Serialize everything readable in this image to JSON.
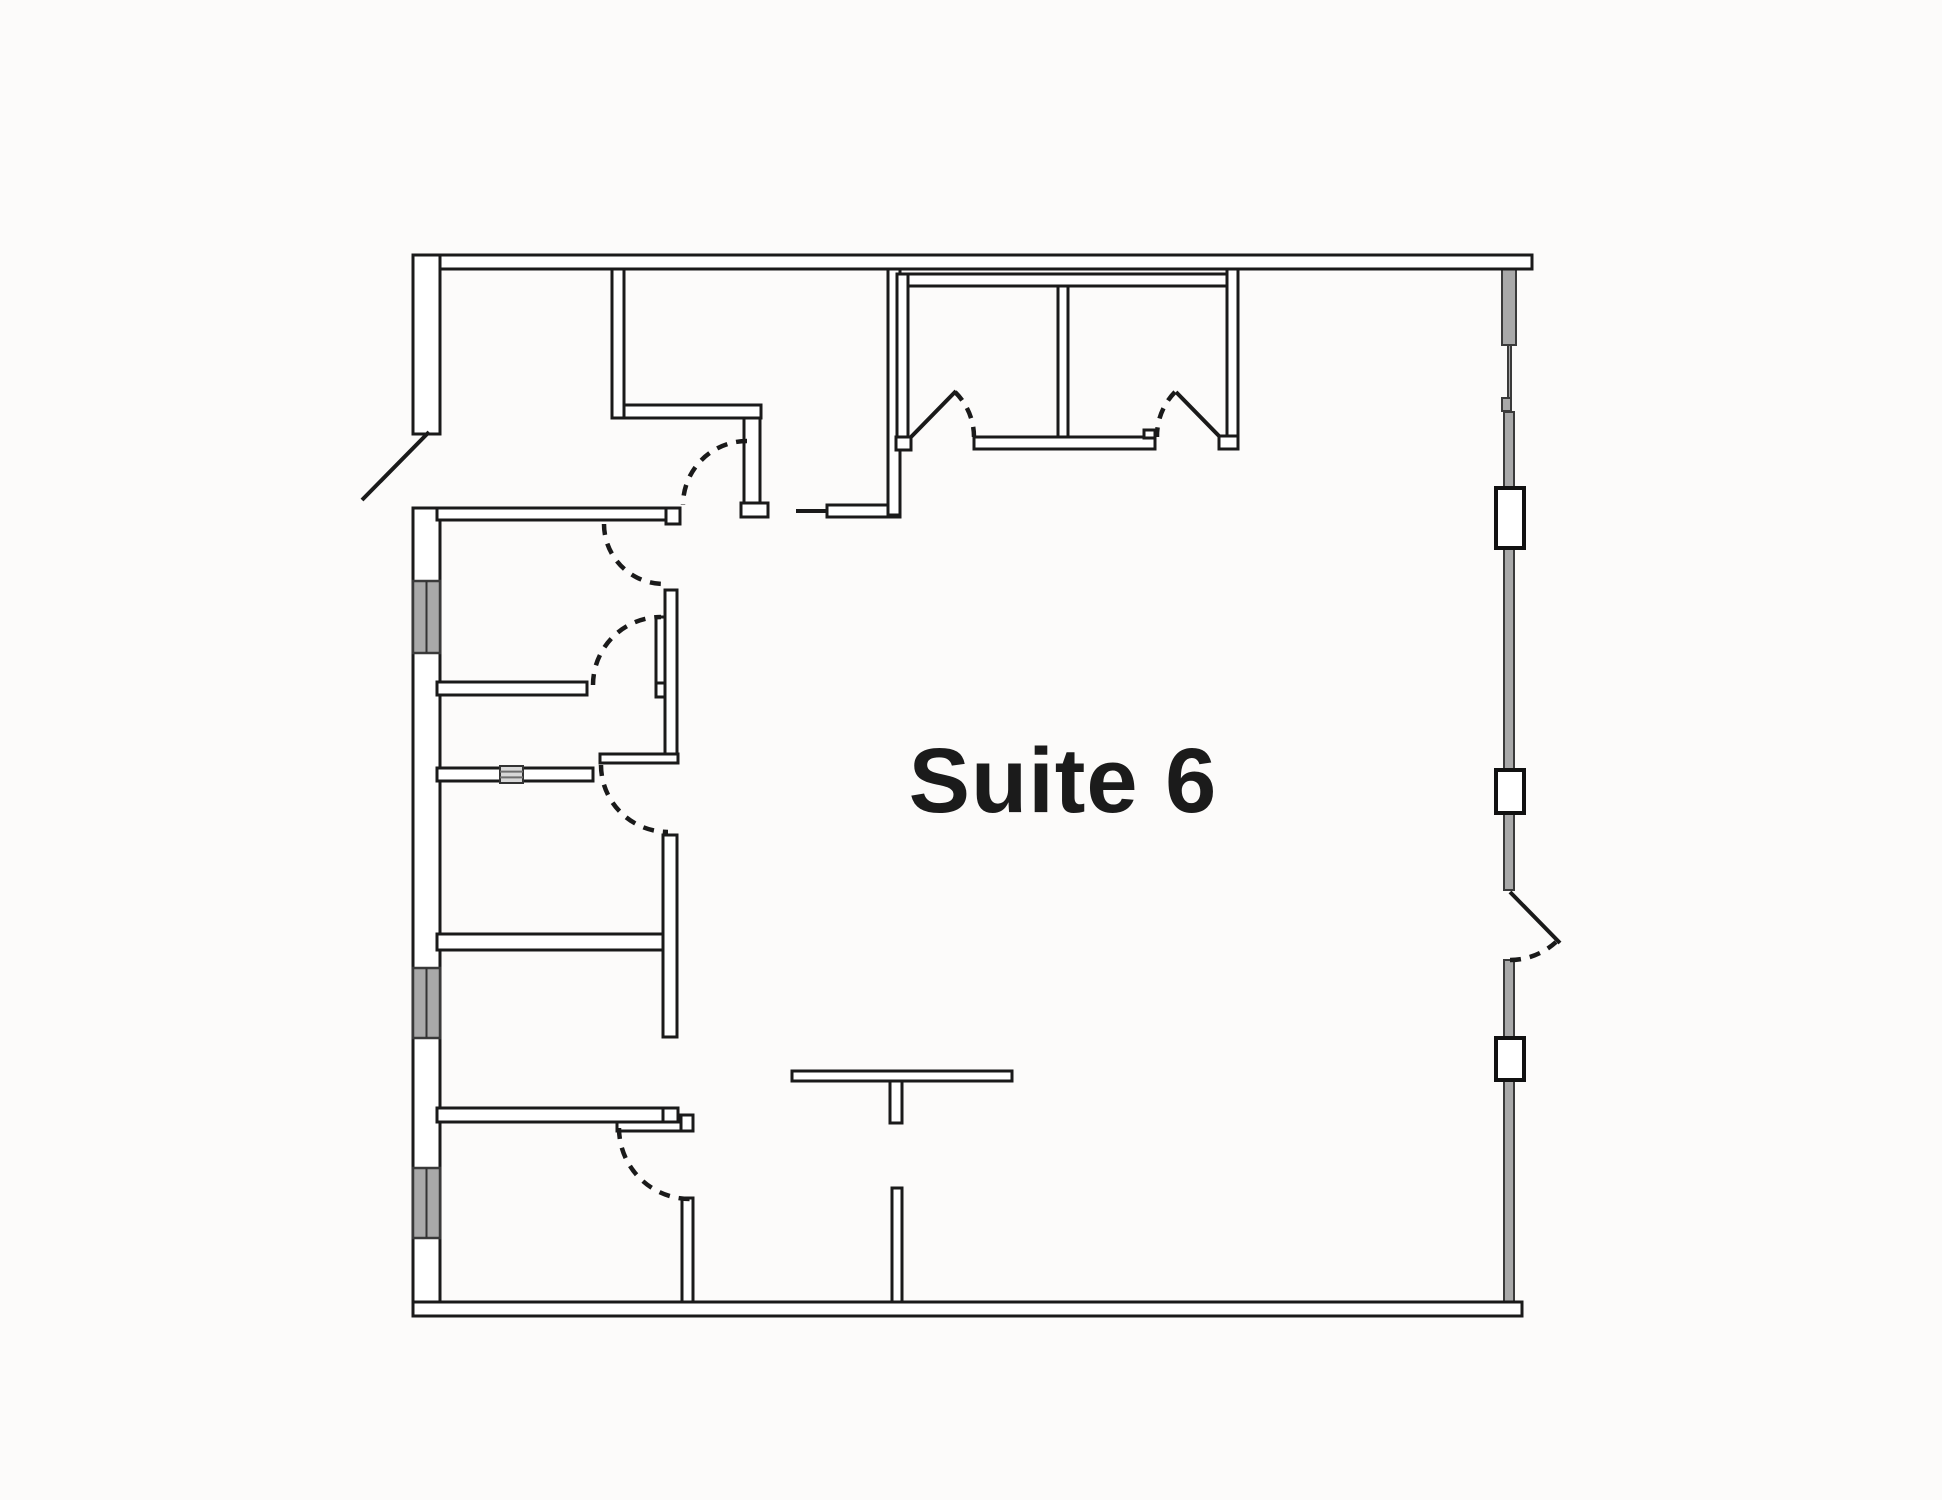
{
  "plan": {
    "label": {
      "text": "Suite 6"
    },
    "colors": {
      "background": "#fcfbfa",
      "wall_stroke": "#1a1a1a",
      "wall_fill": "#ffffff",
      "window_fill": "#a9a9a9",
      "window_stroke": "#3a3a3a",
      "block_stroke": "#111111",
      "label": "#1b1b1b"
    },
    "walls": [
      {
        "name": "top-wall",
        "x": 413,
        "y": 255,
        "w": 1119,
        "h": 14
      },
      {
        "name": "left-wall-upper",
        "x": 413,
        "y": 255,
        "w": 27,
        "h": 179
      },
      {
        "name": "left-wall-lower",
        "x": 413,
        "y": 508,
        "w": 27,
        "h": 794
      },
      {
        "name": "bottom-wall",
        "x": 413,
        "y": 1302,
        "w": 1109,
        "h": 14
      },
      {
        "name": "corridor-top-wall",
        "x": 437,
        "y": 508,
        "w": 243,
        "h": 12
      },
      {
        "name": "corridor-top-wall-jamb",
        "x": 666,
        "y": 508,
        "w": 14,
        "h": 16
      },
      {
        "name": "room-a-right-wall",
        "x": 612,
        "y": 269,
        "w": 12,
        "h": 149
      },
      {
        "name": "vestibule-wall-horizontal",
        "x": 624,
        "y": 405,
        "w": 137,
        "h": 13
      },
      {
        "name": "vestibule-wall-vertical",
        "x": 744,
        "y": 418,
        "w": 16,
        "h": 86
      },
      {
        "name": "vestibule-wall-foot",
        "x": 741,
        "y": 503,
        "w": 27,
        "h": 14
      },
      {
        "name": "corridor-south-wall",
        "x": 827,
        "y": 505,
        "w": 73,
        "h": 12
      },
      {
        "name": "room-b-right-wall",
        "x": 888,
        "y": 269,
        "w": 12,
        "h": 246
      },
      {
        "name": "room-bc-door-jamb",
        "x": 896,
        "y": 437,
        "w": 15,
        "h": 13
      },
      {
        "name": "rooms-cd-top-wall",
        "x": 897,
        "y": 274,
        "w": 340,
        "h": 12
      },
      {
        "name": "room-c-left-wall",
        "x": 897,
        "y": 274,
        "w": 11,
        "h": 163
      },
      {
        "name": "rooms-cd-divider-wall",
        "x": 1058,
        "y": 286,
        "w": 10,
        "h": 151
      },
      {
        "name": "rooms-cd-bottom-wall",
        "x": 974,
        "y": 437,
        "w": 181,
        "h": 12
      },
      {
        "name": "rooms-cd-bottom-notch",
        "x": 1144,
        "y": 430,
        "w": 11,
        "h": 8
      },
      {
        "name": "room-d-right-wall",
        "x": 1227,
        "y": 269,
        "w": 11,
        "h": 168
      },
      {
        "name": "room-d-right-wall-foot",
        "x": 1219,
        "y": 436,
        "w": 19,
        "h": 13
      },
      {
        "name": "left-room1-bottom-wall",
        "x": 437,
        "y": 682,
        "w": 150,
        "h": 13
      },
      {
        "name": "left-door1-leaf",
        "x": 656,
        "y": 617,
        "w": 10,
        "h": 67
      },
      {
        "name": "left-door1-jamb",
        "x": 656,
        "y": 683,
        "w": 18,
        "h": 14
      },
      {
        "name": "left-cluster-east-wall-upper",
        "x": 665,
        "y": 590,
        "w": 12,
        "h": 170
      },
      {
        "name": "left-door2-leaf",
        "x": 600,
        "y": 754,
        "w": 78,
        "h": 9
      },
      {
        "name": "left-room2-bottom-wall",
        "x": 437,
        "y": 768,
        "w": 156,
        "h": 13
      },
      {
        "name": "left-cluster-east-wall-mid",
        "x": 663,
        "y": 835,
        "w": 14,
        "h": 202
      },
      {
        "name": "left-room3-bottom-wall",
        "x": 437,
        "y": 934,
        "w": 226,
        "h": 16
      },
      {
        "name": "left-room4-bottom-wall",
        "x": 437,
        "y": 1108,
        "w": 226,
        "h": 14
      },
      {
        "name": "left-room4-bottom-jamb",
        "x": 663,
        "y": 1108,
        "w": 15,
        "h": 14
      },
      {
        "name": "left-door3-leaf",
        "x": 617,
        "y": 1122,
        "w": 76,
        "h": 9
      },
      {
        "name": "left-door3-leaf-cap",
        "x": 681,
        "y": 1115,
        "w": 12,
        "h": 16
      },
      {
        "name": "left-cluster-east-wall-lower",
        "x": 682,
        "y": 1198,
        "w": 11,
        "h": 104
      },
      {
        "name": "t-wall-bar",
        "x": 792,
        "y": 1071,
        "w": 220,
        "h": 10
      },
      {
        "name": "t-wall-stem",
        "x": 890,
        "y": 1081,
        "w": 12,
        "h": 42
      },
      {
        "name": "bottom-stub-wall",
        "x": 892,
        "y": 1188,
        "w": 10,
        "h": 114
      }
    ],
    "door_leaves": [
      {
        "name": "entry-door-leaf",
        "x1": 429,
        "y1": 432,
        "x2": 362,
        "y2": 500
      },
      {
        "name": "corridor-door-closed-leaf",
        "x1": 796,
        "y1": 511,
        "x2": 827,
        "y2": 511
      },
      {
        "name": "room-c-door-leaf",
        "x1": 911,
        "y1": 437,
        "x2": 956,
        "y2": 391
      },
      {
        "name": "room-d-door-leaf",
        "x1": 1220,
        "y1": 437,
        "x2": 1176,
        "y2": 392
      },
      {
        "name": "right-exit-door-leaf",
        "x1": 1510,
        "y1": 892,
        "x2": 1560,
        "y2": 943
      }
    ],
    "door_swings": [
      {
        "name": "vestibule-door-swing",
        "d": "M747,441 A64,64 0 0 0 683,505"
      },
      {
        "name": "left-room1-entry-swing",
        "d": "M604,524 A60,60 0 0 0 664,584"
      },
      {
        "name": "room-c-door-swing",
        "d": "M955,392 A63,63 0 0 1 974,437"
      },
      {
        "name": "room-d-door-swing",
        "d": "M1175,392 A63,63 0 0 0 1157,437"
      },
      {
        "name": "left-door1-swing",
        "d": "M593,685 A68,68 0 0 1 661,617"
      },
      {
        "name": "left-door2-swing",
        "d": "M601,765 A67,67 0 0 0 668,832"
      },
      {
        "name": "left-door3-swing",
        "d": "M619,1128 A71,71 0 0 0 690,1199"
      },
      {
        "name": "right-exit-door-swing",
        "d": "M1510,960 A68,68 0 0 0 1556,942"
      }
    ],
    "windows": [
      {
        "name": "window-left-1",
        "x": 413,
        "y": 581,
        "w": 27,
        "h": 72
      },
      {
        "name": "window-left-2",
        "x": 413,
        "y": 968,
        "w": 27,
        "h": 70
      },
      {
        "name": "window-left-3",
        "x": 413,
        "y": 1168,
        "w": 27,
        "h": 70
      }
    ],
    "glazing": [
      {
        "name": "right-glazing-1",
        "x": 1502,
        "y": 269,
        "w": 14,
        "h": 76
      },
      {
        "name": "right-glazing-thin",
        "x": 1508,
        "y": 345,
        "w": 3,
        "h": 67
      },
      {
        "name": "right-glazing-tick",
        "x": 1502,
        "y": 398,
        "w": 9,
        "h": 13
      },
      {
        "name": "right-glazing-2",
        "x": 1504,
        "y": 412,
        "w": 10,
        "h": 76
      },
      {
        "name": "right-glazing-3",
        "x": 1504,
        "y": 548,
        "w": 10,
        "h": 222
      },
      {
        "name": "right-glazing-4",
        "x": 1504,
        "y": 813,
        "w": 10,
        "h": 77
      },
      {
        "name": "right-glazing-5",
        "x": 1504,
        "y": 960,
        "w": 10,
        "h": 78
      },
      {
        "name": "right-glazing-6",
        "x": 1504,
        "y": 1080,
        "w": 10,
        "h": 222
      }
    ],
    "mullion_blocks": [
      {
        "name": "right-mullion-1",
        "x": 1496,
        "y": 488,
        "w": 28,
        "h": 60
      },
      {
        "name": "right-mullion-2",
        "x": 1496,
        "y": 770,
        "w": 28,
        "h": 43
      },
      {
        "name": "right-mullion-3",
        "x": 1496,
        "y": 1038,
        "w": 28,
        "h": 42
      }
    ],
    "vent_panel": {
      "name": "vent-panel",
      "x": 500,
      "y": 766,
      "w": 23,
      "h": 17
    }
  }
}
